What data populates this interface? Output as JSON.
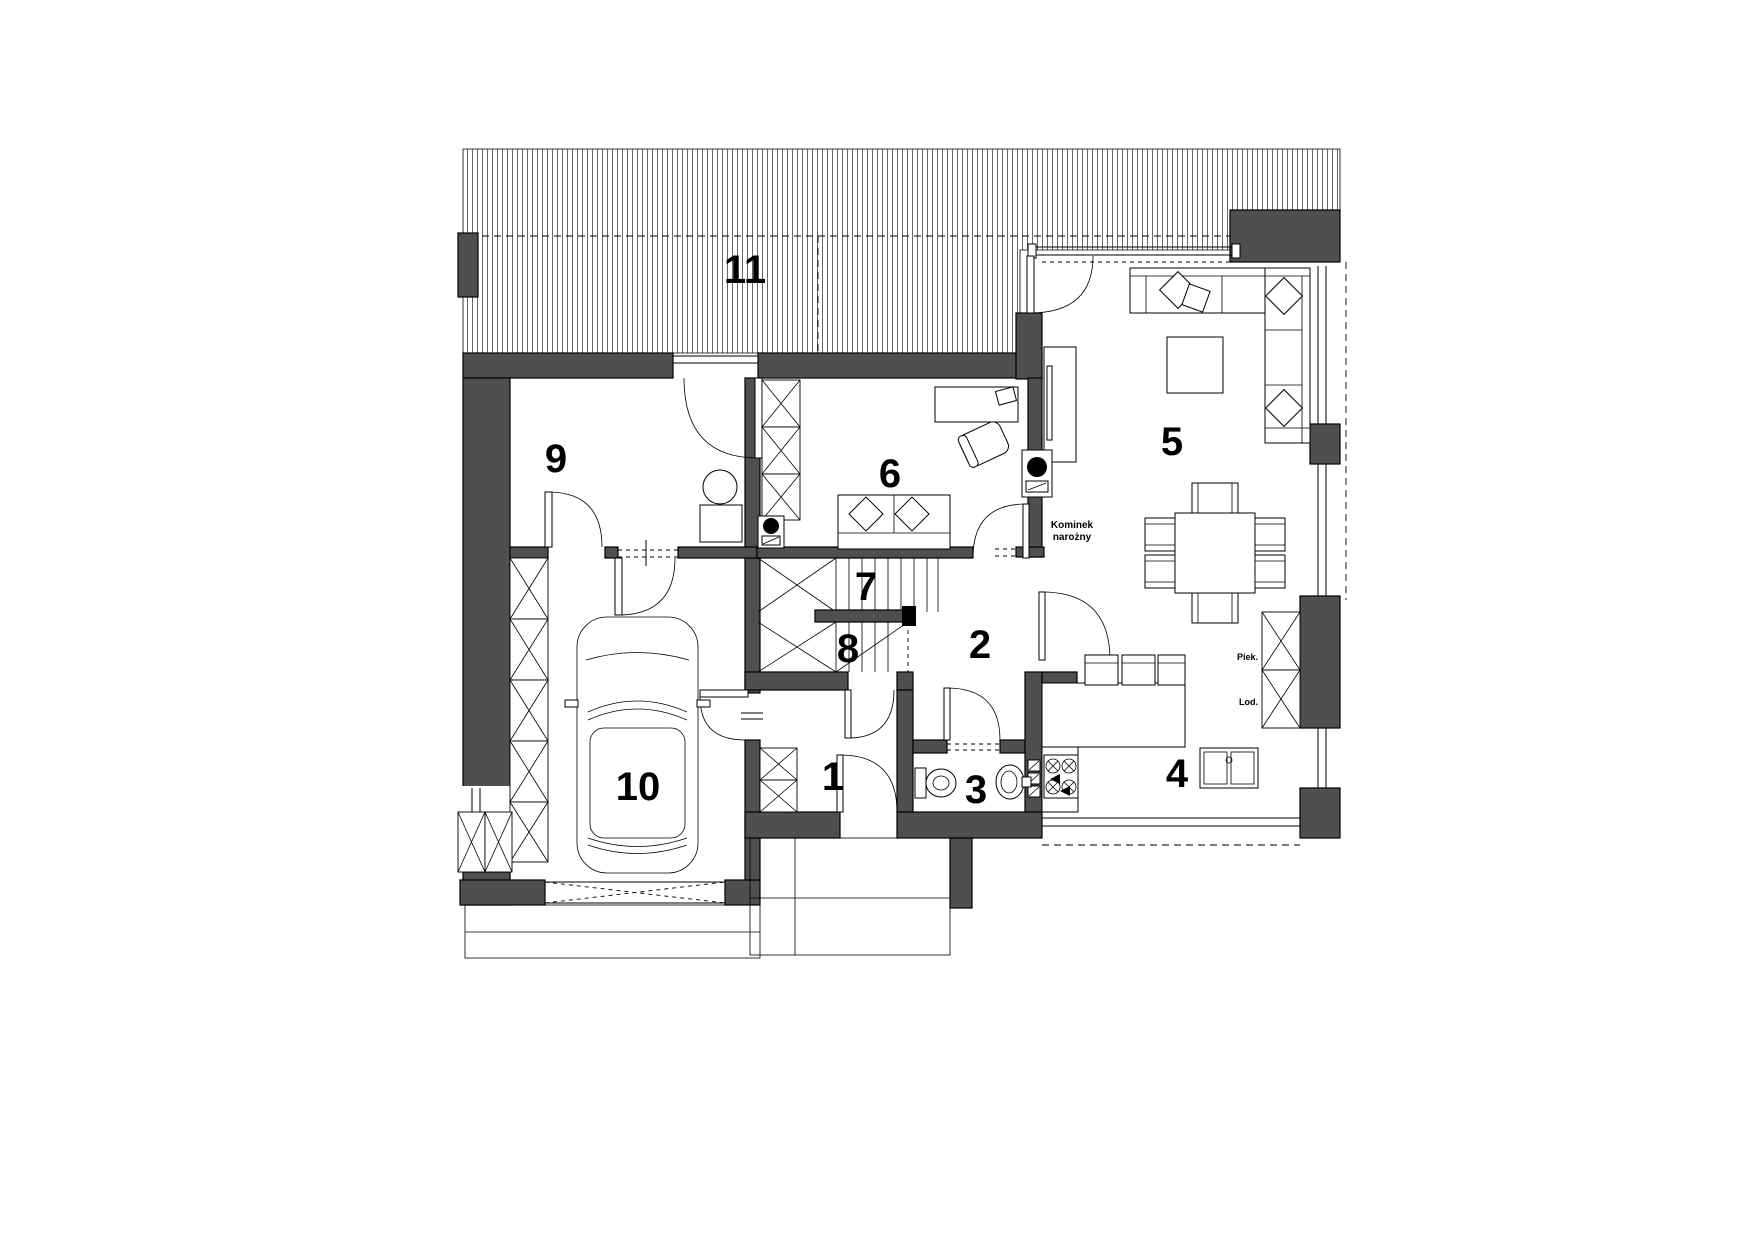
{
  "plan_labels": {
    "rooms": [
      {
        "id": 1,
        "label": "1"
      },
      {
        "id": 2,
        "label": "2"
      },
      {
        "id": 3,
        "label": "3"
      },
      {
        "id": 4,
        "label": "4"
      },
      {
        "id": 5,
        "label": "5"
      },
      {
        "id": 6,
        "label": "6"
      },
      {
        "id": 7,
        "label": "7"
      },
      {
        "id": 8,
        "label": "8"
      },
      {
        "id": 9,
        "label": "9"
      },
      {
        "id": 10,
        "label": "10"
      },
      {
        "id": 11,
        "label": "11"
      }
    ]
  },
  "annotations": {
    "fireplace_line1": "Kominek",
    "fireplace_line2": "narożny",
    "oven_label": "Piek.",
    "fridge_label": "Lod."
  },
  "colors": {
    "wall_fill": "#4f4f4f",
    "line": "#000000",
    "background": "#ffffff"
  }
}
